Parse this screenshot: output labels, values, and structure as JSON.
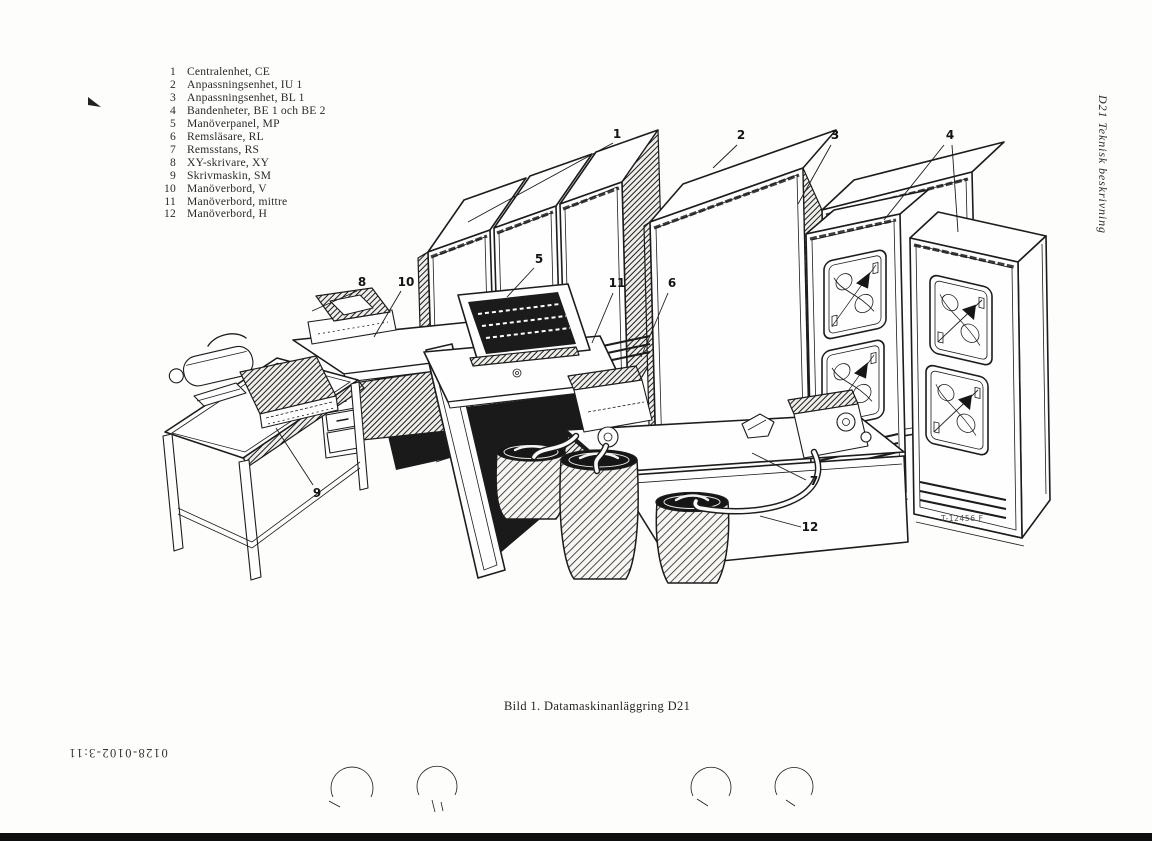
{
  "page": {
    "side_label": "D21 Teknisk beskrivning",
    "doc_number": "0128-0102-3:11"
  },
  "figure": {
    "caption": "Bild 1. Datamaskinanläggring D21",
    "ref_label": "T-12456 F",
    "callouts": [
      "1",
      "2",
      "3",
      "4",
      "5",
      "6",
      "7",
      "8",
      "9",
      "10",
      "11",
      "12"
    ]
  },
  "legend": {
    "items": [
      {
        "num": "1",
        "label": "Centralenhet, CE"
      },
      {
        "num": "2",
        "label": "Anpassningsenhet, IU 1"
      },
      {
        "num": "3",
        "label": "Anpassningsenhet, BL 1"
      },
      {
        "num": "4",
        "label": "Bandenheter, BE 1 och BE 2"
      },
      {
        "num": "5",
        "label": "Manöverpanel, MP"
      },
      {
        "num": "6",
        "label": "Remsläsare, RL"
      },
      {
        "num": "7",
        "label": "Remsstans, RS"
      },
      {
        "num": "8",
        "label": "XY-skrivare, XY"
      },
      {
        "num": "9",
        "label": "Skrivmaskin, SM"
      },
      {
        "num": "10",
        "label": "Manöverbord, V"
      },
      {
        "num": "11",
        "label": "Manöverbord, mittre"
      },
      {
        "num": "12",
        "label": "Manöverbord, H"
      }
    ]
  },
  "colors": {
    "ink": "#1c1c1c",
    "paper": "#fdfdfb",
    "bottom_bar": "#0e0e0e"
  }
}
